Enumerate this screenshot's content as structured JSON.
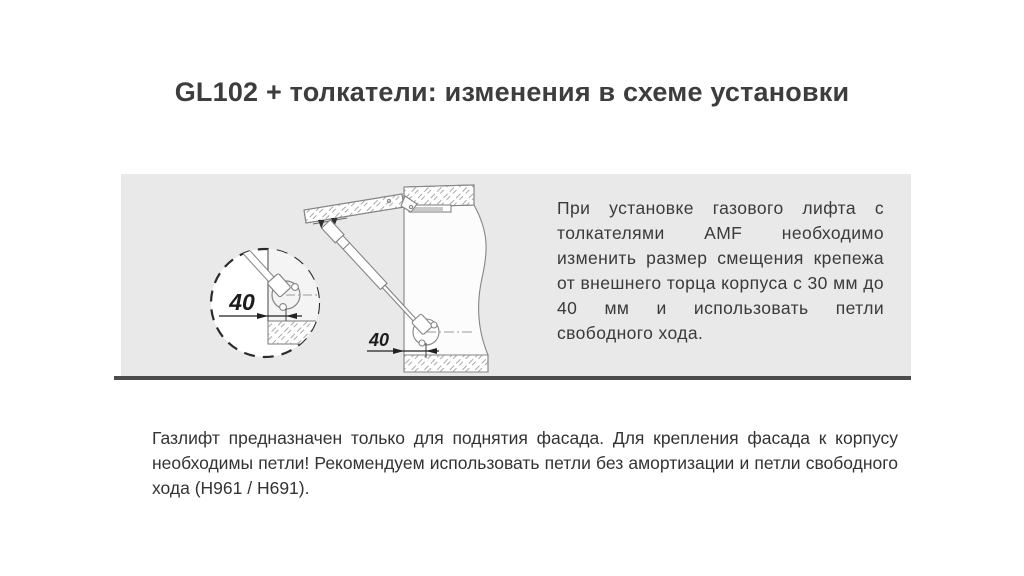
{
  "page": {
    "title": "GL102 + толкатели: изменения в схеме установки"
  },
  "panel": {
    "description": "При установке газового лифта с толкателями AMF необходимо изменить размер смещения крепежа от внешнего торца корпуса с 30 мм до 40 мм и использовать петли свободного хода.",
    "diagram": {
      "detail_dimension_label": "40",
      "main_dimension_label": "40"
    }
  },
  "footer": {
    "note": "Газлифт предназначен только для поднятия фасада. Для крепления фасада к корпусу необходимы петли! Рекомендуем использовать петли без амортизации и петли свободного хода (H961 / H691)."
  },
  "colors": {
    "panel_background": "#e9e9e9",
    "divider_rule": "#4d4d4d",
    "text": "#3a3a3a"
  }
}
